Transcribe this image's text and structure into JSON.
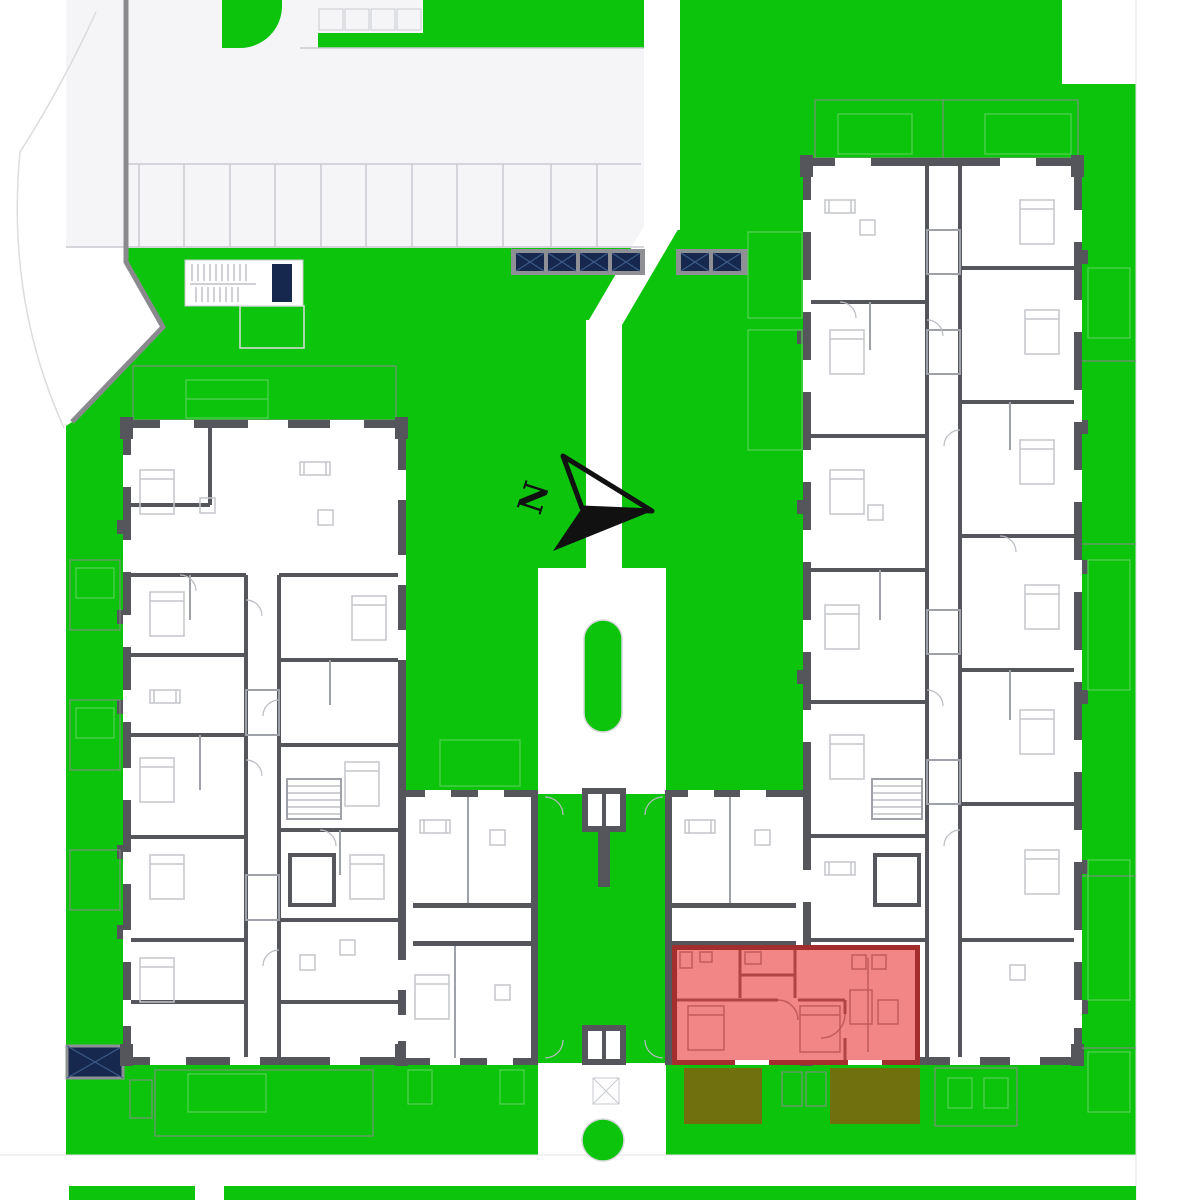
{
  "title": "residential-site-floor-plan",
  "compass": {
    "label": "N"
  },
  "colors": {
    "lawn": "#0cc40c",
    "road": "#f5f5f7",
    "road_line": "#c9cad0",
    "edge_gray": "#8a8a8e",
    "wall": "#54565c",
    "partition": "#9fa1a8",
    "furniture": "#c3c5cb",
    "navy": "#16284e",
    "navy_line": "#3c5b86",
    "frame_gray": "#8f9096",
    "red_fill": "#f28585",
    "red_wall": "#a32e2e",
    "red_partition": "#b24343",
    "red_furniture": "#c35b5b",
    "olive": "#70700e",
    "plot_line": "#8b8b8b",
    "plot_grid": "#57d057",
    "black": "#111111"
  }
}
